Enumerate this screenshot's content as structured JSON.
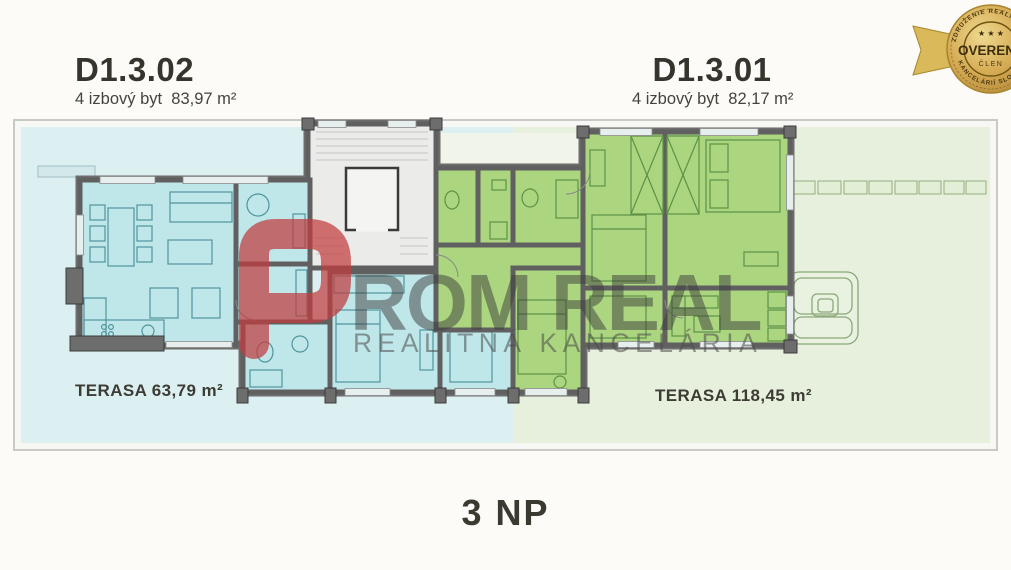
{
  "apartment_left": {
    "id": "D1.3.02",
    "subtitle": "4 izbový byt  83,97 m²",
    "terrace_label": "TERASA 63,79 m²"
  },
  "apartment_right": {
    "id": "D1.3.01",
    "subtitle": "4 izbový byt  82,17 m²",
    "terrace_label": "TERASA 118,45 m²"
  },
  "floor_label": "3 NP",
  "watermark": {
    "logo_letter": "P",
    "brand": "ROM REAL",
    "tagline": "REALITNÁ KANCELÁRIA"
  },
  "badge": {
    "arc_top": "ZDRUŽENIE REALITNÝCH",
    "arc_bottom": "KANCELÁRIÍ SLOVENSKA",
    "stars": "★ ★ ★",
    "center_line1": "OVERENÝ",
    "center_line2": "ČLEN"
  },
  "colors": {
    "terrace_left": "#dceff1",
    "terrace_right": "#e7f0dd",
    "room_cyan": "#bfe7ea",
    "room_green": "#abd57f",
    "stairwell": "#ebebe9",
    "wall": "#6d6d6d",
    "watermark_red": "#c13c3e",
    "badge_gold": "#d6ac55",
    "text": "#3a3a32"
  }
}
